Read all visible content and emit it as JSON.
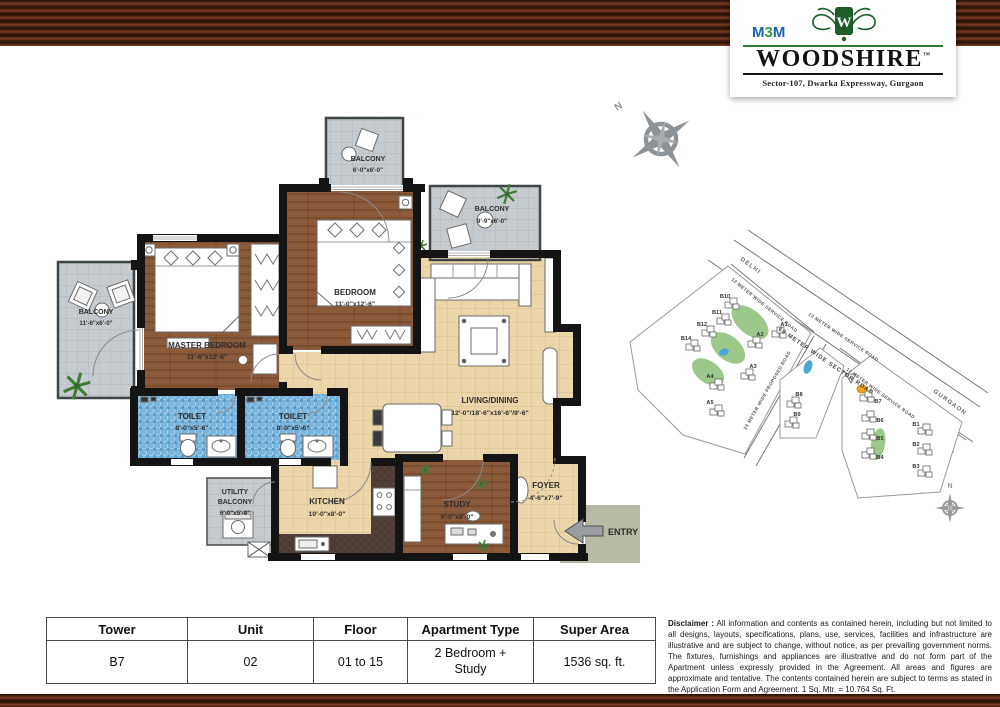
{
  "header": {
    "brand_m1": "M",
    "brand_3": "3",
    "brand_m2": "M",
    "crest_letter": "W",
    "name": "WOODSHIRE",
    "tm": "™",
    "tagline": "Sector-107, Dwarka Expressway, Gurgaon"
  },
  "floorplan": {
    "compass_n": "N",
    "entry_label": "ENTRY",
    "rooms": {
      "master": {
        "name": "MASTER BEDROOM",
        "dims": "11'-6\"x12'-6\""
      },
      "bedroom": {
        "name": "BEDROOM",
        "dims": "11'-0\"x12'-6\""
      },
      "living": {
        "name": "LIVING/DINING",
        "dims": "12'-0\"/18'-6\"x16'-6\"/9'-6\""
      },
      "toilet1": {
        "name": "TOILET",
        "dims": "8'-0\"x5'-6\""
      },
      "toilet2": {
        "name": "TOILET",
        "dims": "8'-0\"x5'-6\""
      },
      "kitchen": {
        "name": "KITCHEN",
        "dims": "10'-0\"x8'-0\""
      },
      "study": {
        "name": "STUDY",
        "dims": "9'-0\"x8'-0\""
      },
      "foyer": {
        "name": "FOYER",
        "dims": "4'-6\"x7'-9\""
      },
      "utility_line1": "UTILITY",
      "utility_line2": "BALCONY",
      "utility_dims": "6'-0\"x5'-9\"",
      "balcony_left": {
        "name": "BALCONY",
        "dims": "11'-6\"x6'-0\""
      },
      "balcony_top": {
        "name": "BALCONY",
        "dims": "6'-0\"x6'-0\""
      },
      "balcony_right": {
        "name": "BALCONY",
        "dims": "9'-9\"x6'-0\""
      }
    }
  },
  "sitemap": {
    "delhi": "DELHI",
    "gurgaon": "GURGAON",
    "sector_road": "60 METER WIDE SECTOR ROAD",
    "service_road": "12 METER WIDE SERVICE ROAD",
    "proposed_road": "24 METER WIDE PROPOSED ROAD",
    "compass_n": "N",
    "towers": [
      "B10",
      "B11",
      "B12",
      "B14",
      "A1",
      "A2",
      "A3",
      "A4",
      "A5",
      "B8",
      "B9",
      "B7",
      "B6",
      "B5",
      "B4",
      "B1",
      "B2",
      "B3"
    ],
    "highlighted_tower": "B7"
  },
  "table": {
    "headers": [
      "Tower",
      "Unit",
      "Floor",
      "Apartment Type",
      "Super Area"
    ],
    "values": [
      "B7",
      "02",
      "01 to 15",
      "2 Bedroom + Study",
      "1536 sq. ft."
    ]
  },
  "disclaimer": {
    "label": "Disclaimer :",
    "text": "All information and contents as contained herein, including but not limited to all designs, layouts, specifications, plans, use, services, facilities and infrastructure are illustrative and are subject to change, without notice, as per prevailing government norms. The fixtures, furnishings and appliances are illustrative and do not form part of the Apartment unless expressly provided in the Agreement. All areas and figures are approximate and tentative. The contents contained herein are subject to terms as stated in the Application Form and Agreement. 1 Sq. Mtr. = 10.764 Sq. Ft."
  },
  "colors": {
    "brand_green": "#1e5c28",
    "brand_blue": "#1464b4",
    "highlight_orange": "#f2a124"
  }
}
